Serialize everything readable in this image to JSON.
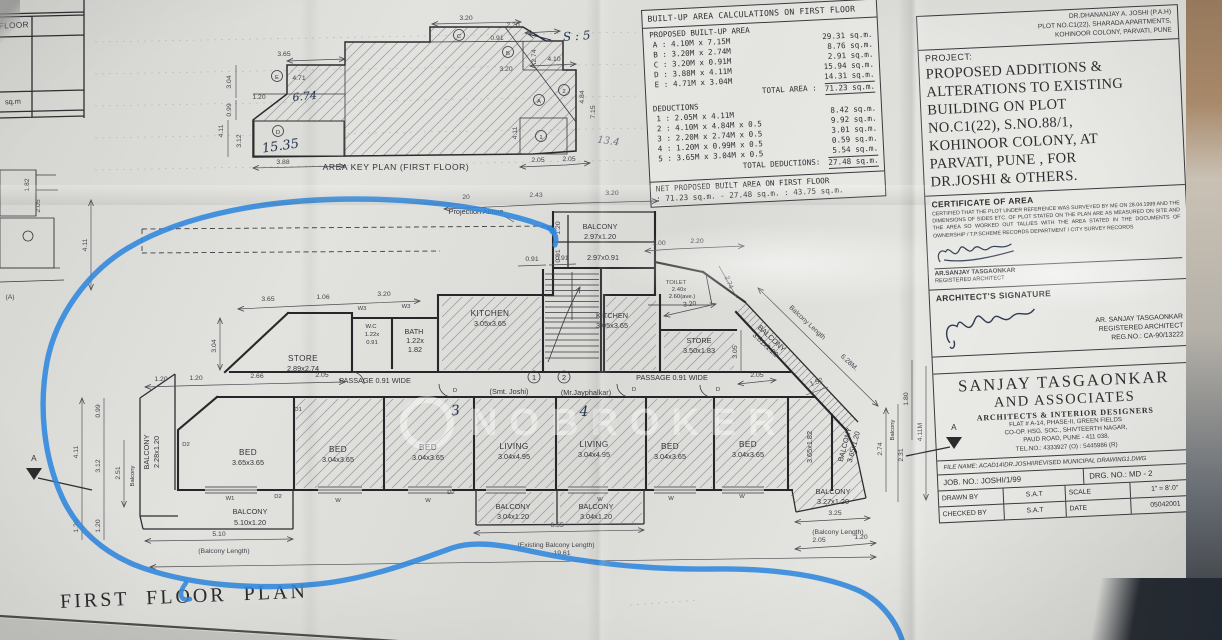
{
  "watermark": {
    "text": "NOBROKER"
  },
  "frag": {
    "floor": "FLOOR",
    "sqm": "sq.m",
    "d182": "1.82",
    "d411": "4.11",
    "d205": "2.05",
    "a": "(A)"
  },
  "area_table": {
    "title": "BUILT-UP AREA CALCULATIONS ON FIRST FLOOR",
    "sec1": "PROPOSED BUILT-UP AREA",
    "rows": [
      {
        "l": "A : 4.10M x 7.15M",
        "r": "29.31 sq.m."
      },
      {
        "l": "B : 3.20M x 2.74M",
        "r": "8.76 sq.m."
      },
      {
        "l": "C : 3.20M x 0.91M",
        "r": "2.91 sq.m."
      },
      {
        "l": "D : 3.88M x 4.11M",
        "r": "15.94 sq.m."
      },
      {
        "l": "E : 4.71M x 3.04M",
        "r": "14.31 sq.m."
      }
    ],
    "total_l": "TOTAL AREA :",
    "total_r": "71.23 sq.m.",
    "sec2": "DEDUCTIONS",
    "ded_rows": [
      {
        "l": "1 : 2.05M x 4.11M",
        "r": "8.42 sq.m."
      },
      {
        "l": "2 : 4.10M x 4.84M x 0.5",
        "r": "9.92 sq.m."
      },
      {
        "l": "3 : 2.20M x 2.74M x 0.5",
        "r": "3.01 sq.m."
      },
      {
        "l": "4 : 1.20M x 0.99M x 0.5",
        "r": "0.59 sq.m."
      },
      {
        "l": "5 : 3.65M x 3.04M x 0.5",
        "r": "5.54 sq.m."
      }
    ],
    "ded_total_l": "TOTAL DEDUCTIONS:",
    "ded_total_r": "27.48 sq.m.",
    "net1": "NET PROPOSED BUILT AREA ON FIRST FLOOR",
    "net2": ": 71.23 sq.m. - 27.48 sq.m. : 43.75 sq.m."
  },
  "key_plan": {
    "caption": "AREA KEY PLAN (FIRST FLOOR)",
    "z_a": "A",
    "z_b": "B",
    "z_c": "C",
    "z_d": "D",
    "z_e": "E",
    "z_1": "1",
    "z_2": "2",
    "d471": "4.71",
    "d320t": "3.20",
    "d220": "2.20",
    "d091": "0.91",
    "d365": "3.65",
    "d274": "2.74",
    "d410": "4.10",
    "d320m": "3.20",
    "d484": "4.84",
    "d715": "7.15",
    "d304": "3.04",
    "d099": "0.99",
    "d411": "4.11",
    "d312": "3.12",
    "d120": "1.20",
    "d388": "3.88",
    "d205a": "2.05",
    "d205b": "2.05",
    "d411b": "4.11",
    "pen1": "15.35",
    "pen2": "6.74",
    "pen3": "S : 5",
    "pen4": "13.4"
  },
  "plan": {
    "title": "FIRST FLOOR PLAN",
    "projection": "Projection Above",
    "u1n": "1",
    "u1": "(Smt. Joshi)",
    "u2n": "2",
    "u2": "(Mr.Jayphalkar)",
    "p3": "3",
    "p4": "4",
    "rooms": {
      "store": "STORE",
      "store_l_s": "2.89x2.74",
      "store_r_s": "3.50x1.83",
      "wc": "W.C",
      "wc1": "1.22x",
      "wc2": "0.91",
      "bath": "BATH",
      "bath1": "1.22x",
      "bath2": "1.82",
      "kitchen": "KITCHEN",
      "kitchen_s": "3.05x3.65",
      "toilet": "TOILET",
      "toilet1": "2.40x",
      "toilet2": "2.60(ave.)",
      "passage": "PASSAGE 0.91 WIDE",
      "bed": "BED",
      "bed_l_s": "3.65x3.65",
      "bed_s": "3.04x3.65",
      "living": "LIVING",
      "living_s": "3.04x4.95",
      "se_room_s": "3.65x1.82",
      "balcony": "BALCONY",
      "balc_t1": "2.97x1.20",
      "balc_t2": "2.97x0.91",
      "balc_w": "2.28x1.20",
      "balc_b1": "5.10x1.20",
      "balc_b2": "3.04x1.20",
      "balc_r": "3.27x1.20",
      "balc_diag": "3.81x1.20",
      "balc_se": "3.65x1.20"
    },
    "dims": {
      "d20": "20",
      "d243": "2.43",
      "d320a": "3.20",
      "d100": "1.00",
      "d220": "2.20",
      "d091a": "0.91",
      "d091b": "0.91",
      "d120t": "1.20",
      "d091t": "0.91",
      "d365": "3.65",
      "d106": "1.06",
      "d320b": "3.20",
      "d304": "3.04",
      "d120a": "1.20",
      "d120b": "1.20",
      "d266": "2.66",
      "d205a": "2.05",
      "d320c": "3.20",
      "d274a": "2.74",
      "d305": "3.05",
      "d205b": "2.05",
      "d152": "1.52",
      "bal_len": "Balcony Length",
      "d628": "6.28M.",
      "d510": "5.10",
      "bl": "(Balcony Length)",
      "d655": "6.55",
      "ebl": "(Existing Balcony Length)",
      "d1961": "19.61",
      "d325": "3.25",
      "d205c": "2.05",
      "d120c": "1.20",
      "d099": "0.99",
      "d411": "4.11",
      "d312": "3.12",
      "d251": "2.51",
      "balv": "Balcony",
      "d120d": "1.20",
      "d120e": "1.20",
      "d274b": "2.74",
      "d231": "2.31",
      "d180": "1.80",
      "d411m": "4.11M"
    },
    "markers": {
      "w": "W",
      "w1": "W1",
      "w3": "W3",
      "d": "D",
      "d1": "D1",
      "d2": "D2",
      "a": "A"
    }
  },
  "title_block": {
    "client1": "DR.DHANANJAY A. JOSHI (P.A.H)",
    "client2": "PLOT NO.C1(22), SHARADA APARTMENTS,",
    "client3": "KOHINOOR COLONY, PARVATI, PUNE",
    "project_label": "PROJECT:",
    "project_lines": [
      "PROPOSED ADDITIONS &",
      "ALTERATIONS TO EXISTING",
      "BUILDING ON PLOT",
      "NO.C1(22), S.NO.88/1,",
      "KOHINOOR COLONY, AT",
      "PARVATI, PUNE , FOR",
      "DR.JOSHI & OTHERS."
    ],
    "cert_title": "CERTIFICATE OF AREA",
    "cert_text": "CERTIFIED THAT THE PLOT UNDER REFERENCE WAS SURVEYED BY ME ON 28.04.1999 AND THE DIMENSIONS OF SIDES ETC. OF PLOT STATED ON THE PLAN ARE AS MEASURED ON SITE AND THE AREA SO WORKED OUT TALLIES WITH THE AREA STATED IN THE DOCUMENTS OF OWNERSHIP / T.P.SCHEME RECORDS DEPARTMENT / CITY SURVEY RECORDS",
    "cert_name": "AR.SANJAY TASGAONKAR",
    "cert_role": "REGISTERED ARCHITECT",
    "sig_title": "ARCHITECT'S SIGNATURE",
    "sig_name": "AR. SANJAY TASGAONKAR",
    "sig_role": "REGISTERED ARCHITECT",
    "sig_reg": "REG.NO.: CA-90/13222",
    "firm1": "SANJAY TASGAONKAR",
    "firm2": "AND ASSOCIATES",
    "firm3": "ARCHITECTS & INTERIOR DESIGNERS",
    "addr1": "FLAT # A-14, PHASE-II, GREEN FIELDS",
    "addr2": "CO-OP. HSG. SOC., SHIVTEERTH NAGAR,",
    "addr3": "PAUD ROAD, PUNE - 411 038.",
    "tel": "TEL.NO.: 4333927 (O) : 5445986 (R)",
    "file": "FILE NAME: ACAD14\\DR.JOSHI\\REVISED MUNICIPAL DRAWING1.DWG",
    "job": "JOB. NO.: JOSHI/1/99",
    "drg": "DRG. NO.: MD - 2",
    "drawn_l": "DRAWN BY",
    "drawn_v": "S.A.T",
    "scale_l": "SCALE",
    "scale_v": "1\" = 8'.0\"",
    "checked_l": "CHECKED BY",
    "checked_v": "S.A.T",
    "date_l": "DATE",
    "date_v": "05042001"
  }
}
